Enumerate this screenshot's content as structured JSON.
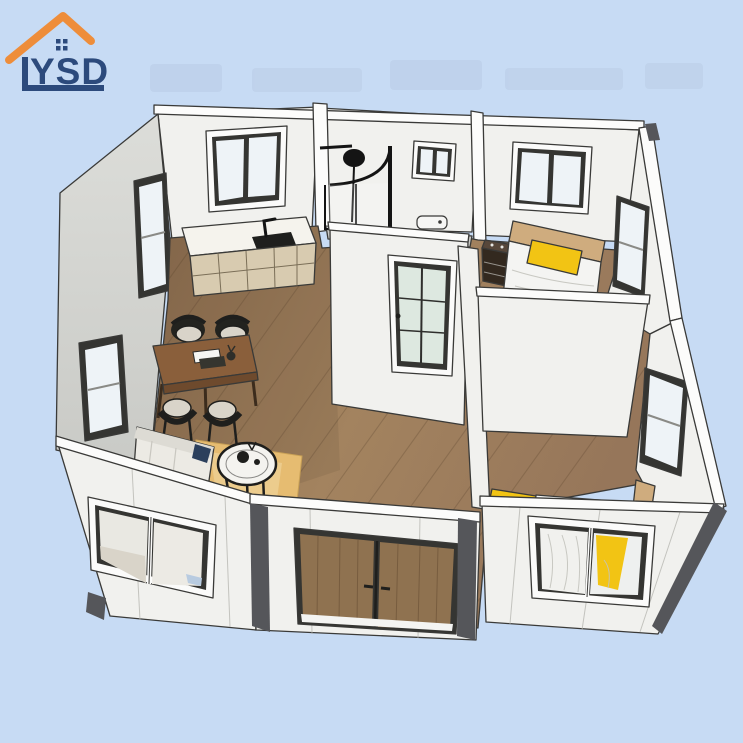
{
  "image": {
    "kind": "3d-isometric-floor-plan-product-render",
    "width_px": 743,
    "height_px": 743
  },
  "logo": {
    "text": "YSD",
    "roof_icon": "orange-house-roof-with-window",
    "roof_color": "#ee8d3a",
    "text_color": "#2c4a7c"
  },
  "colors": {
    "background": "#c7dbf4",
    "wall_white": "#f1f1ee",
    "wall_gray": "#d6d7d3",
    "wood_floor": "#97785a",
    "cabinet": "#d8cbb0",
    "counter": "#f5f3ed",
    "accent_yellow": "#f2c414",
    "fixture_black": "#1f1f1d",
    "door_wood": "#8f7250",
    "trim_gray": "#55565a",
    "glass": "#eef3f7",
    "glass_green": "#dde8e0",
    "rug": "#e6bc71",
    "bed_white": "#f4f4f2",
    "headboard": "#cfac7e",
    "logo_navy": "#2c4a7c",
    "line": "#3a3a38"
  },
  "scene": {
    "elements": [
      "kitchen-counter-with-sink-and-faucet",
      "kitchen-cabinets",
      "dining-table-with-books-and-jar",
      "four-dining-chairs",
      "sofa-with-navy-cushion",
      "round-coffee-table-with-kettle",
      "tan-area-rug",
      "bathroom-shower-enclosure",
      "shower-head",
      "toilet",
      "glass-pane-interior-door",
      "bed-with-yellow-pillow-back-bedroom",
      "dark-nightstand",
      "bed-with-yellow-pillow-front-bedroom",
      "wood-double-entry-door",
      "exterior-windows",
      "wood-plank-flooring",
      "white-wall-panels-with-dark-corner-trims"
    ]
  }
}
